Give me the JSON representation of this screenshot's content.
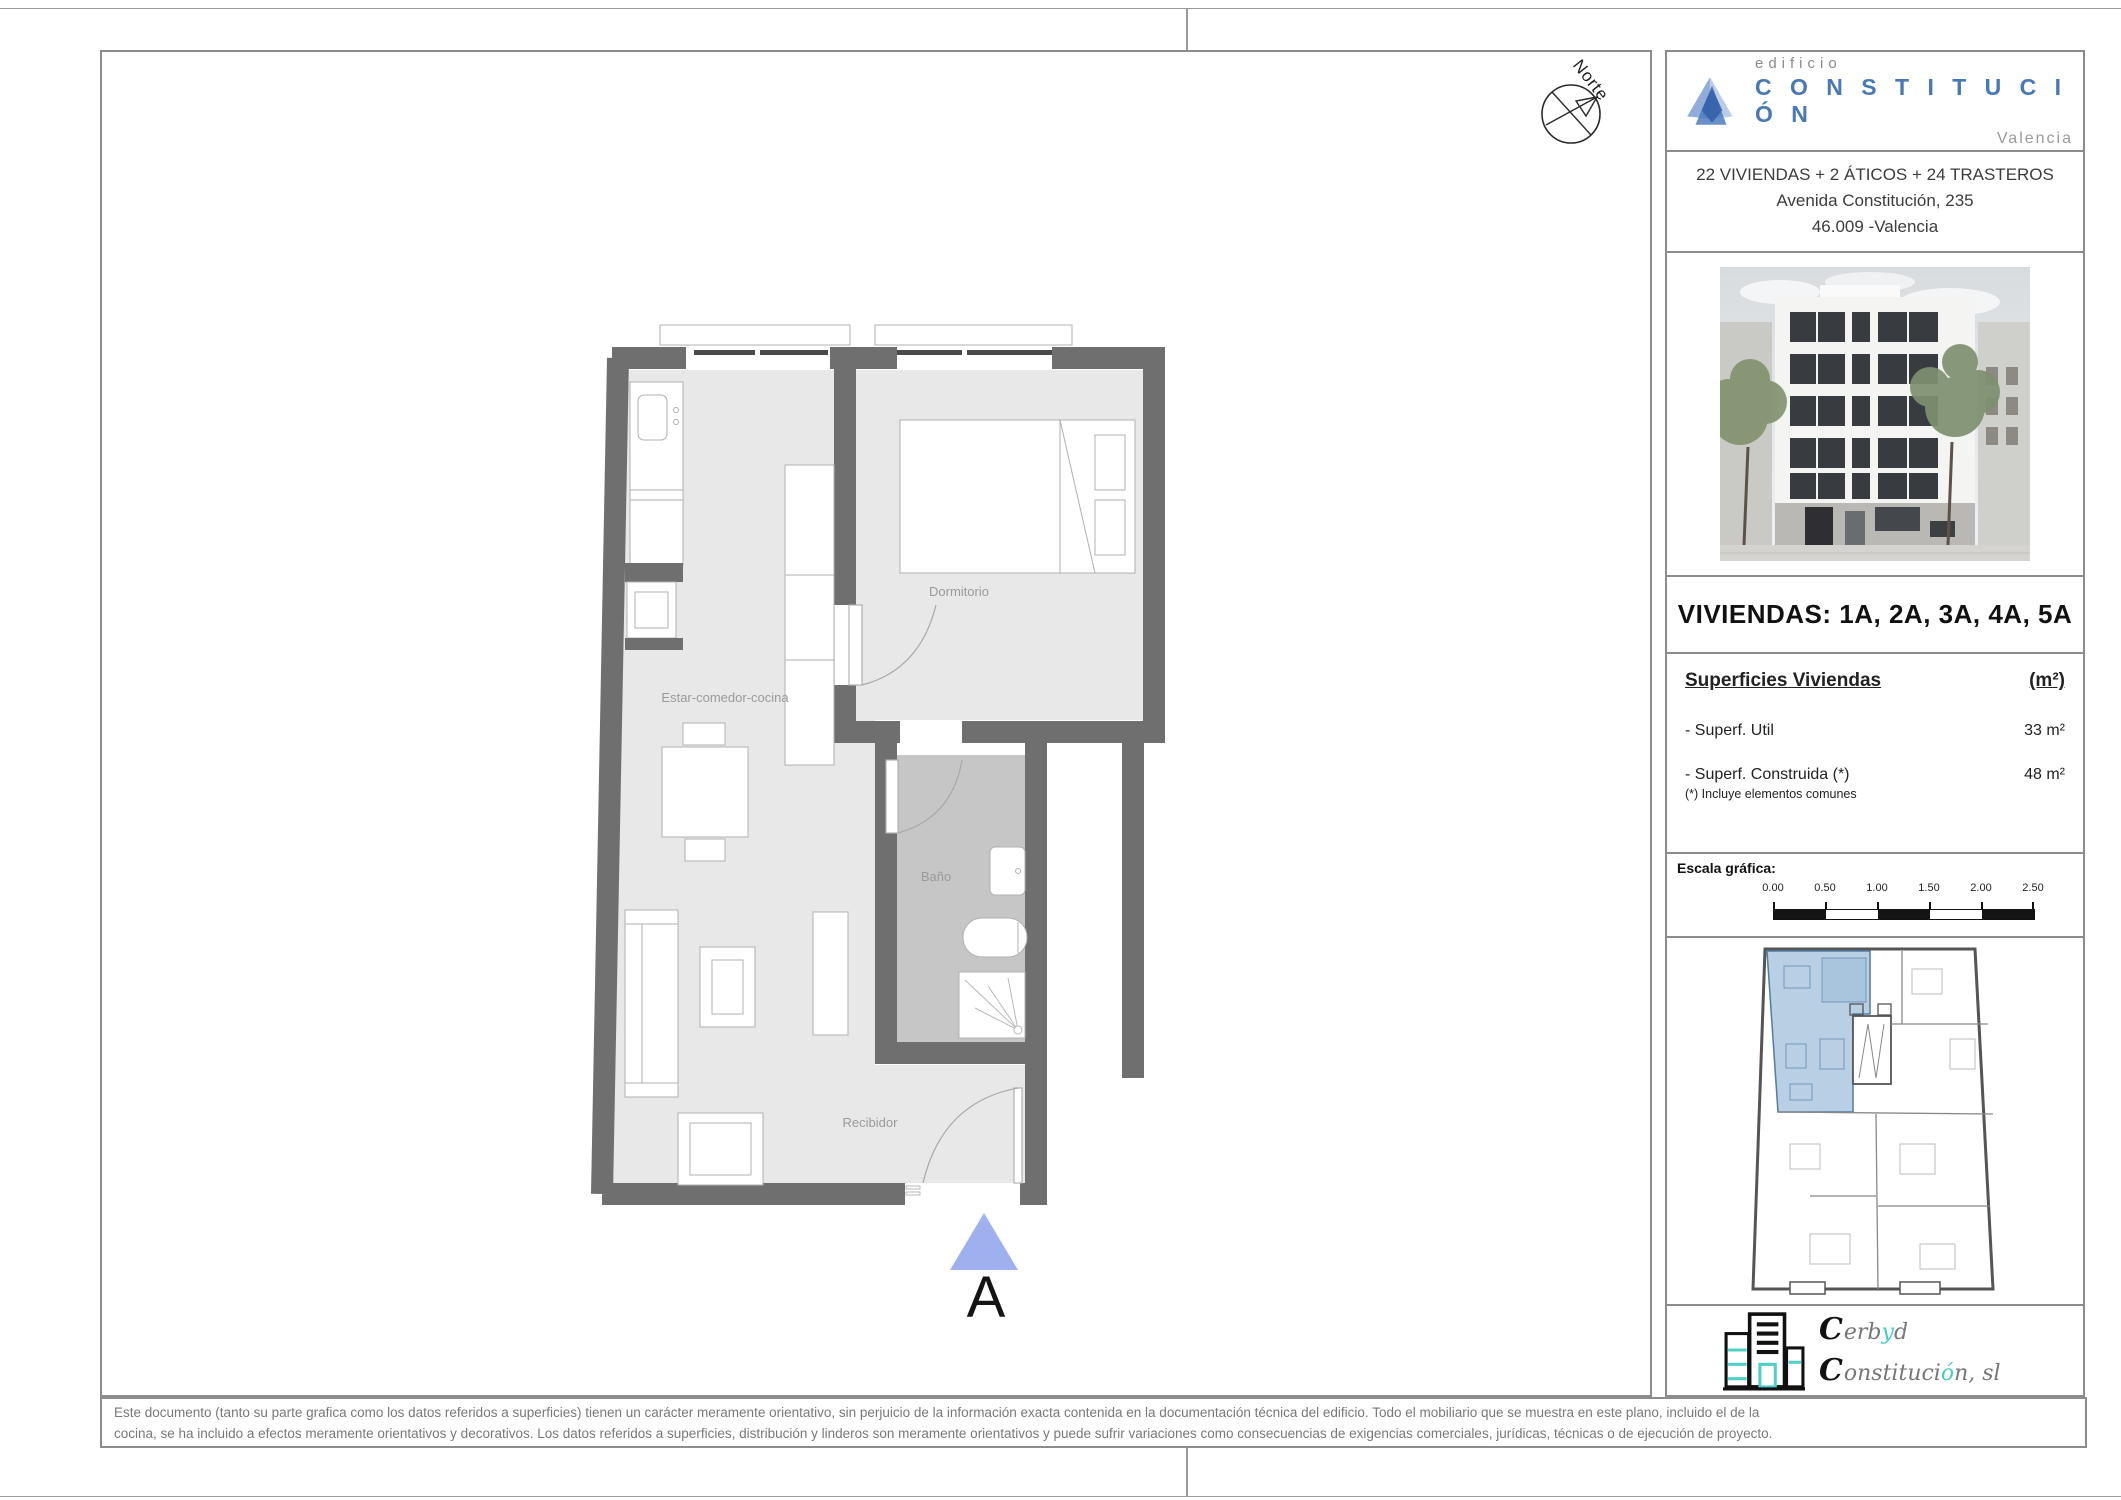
{
  "colors": {
    "accent_blue": "#4679b6",
    "wall_gray": "#6f6f6f",
    "floor_gray": "#e8e8e8",
    "bath_floor_gray": "#c6c6c6",
    "keyplan_highlight": "#b9cfe4",
    "marker_triangle": "#9fb0ef",
    "cerbyd_teal": "#45cec5"
  },
  "title_block": {
    "logo": {
      "line1": "edificio",
      "line2": "C O N S T I T U C I Ó N",
      "line3": "Valencia"
    },
    "project": {
      "line1": "22 VIVIENDAS + 2 ÁTICOS + 24 TRASTEROS",
      "line2": "Avenida Constitución, 235",
      "line3": "46.009 -Valencia"
    },
    "viviendas_title": "VIVIENDAS: 1A, 2A, 3A, 4A, 5A",
    "superficies": {
      "header": "Superficies Viviendas",
      "unit_header": "(m²)",
      "rows": [
        {
          "label": "- Superf. Util",
          "value": "33 m²"
        },
        {
          "label": "- Superf. Construida (*)",
          "value": "48 m²"
        }
      ],
      "note": "(*) Incluye elementos comunes"
    },
    "escala": {
      "label": "Escala gráfica:",
      "ticks": [
        "0.00",
        "0.50",
        "1.00",
        "1.50",
        "2.00",
        "2.50"
      ]
    },
    "cerbyd": {
      "c1": "C",
      "r1a": "erb",
      "a1": "y",
      "r1b": "d",
      "c2": "C",
      "r2a": "onstituci",
      "a2": "ó",
      "r2b": "n, sl"
    }
  },
  "plan": {
    "north_label": "Norte",
    "rooms": [
      {
        "name": "Estar-comedor-cocina"
      },
      {
        "name": "Dormitorio"
      },
      {
        "name": "Baño"
      },
      {
        "name": "Recibidor"
      }
    ],
    "marker": "A"
  },
  "footer": {
    "line1": "Este documento (tanto su parte grafica como los datos referidos a superficies) tienen un carácter meramente orientativo, sin perjuicio de la información exacta contenida en la documentación técnica del edificio. Todo el mobiliario que se muestra en este plano, incluido el de la",
    "line2": "cocina, se ha incluido a efectos meramente orientativos y decorativos. Los datos referidos a superficies, distribución y linderos son meramente orientativos y puede sufrir variaciones como consecuencias de exigencias comerciales, jurídicas, técnicas o de ejecución de proyecto."
  }
}
